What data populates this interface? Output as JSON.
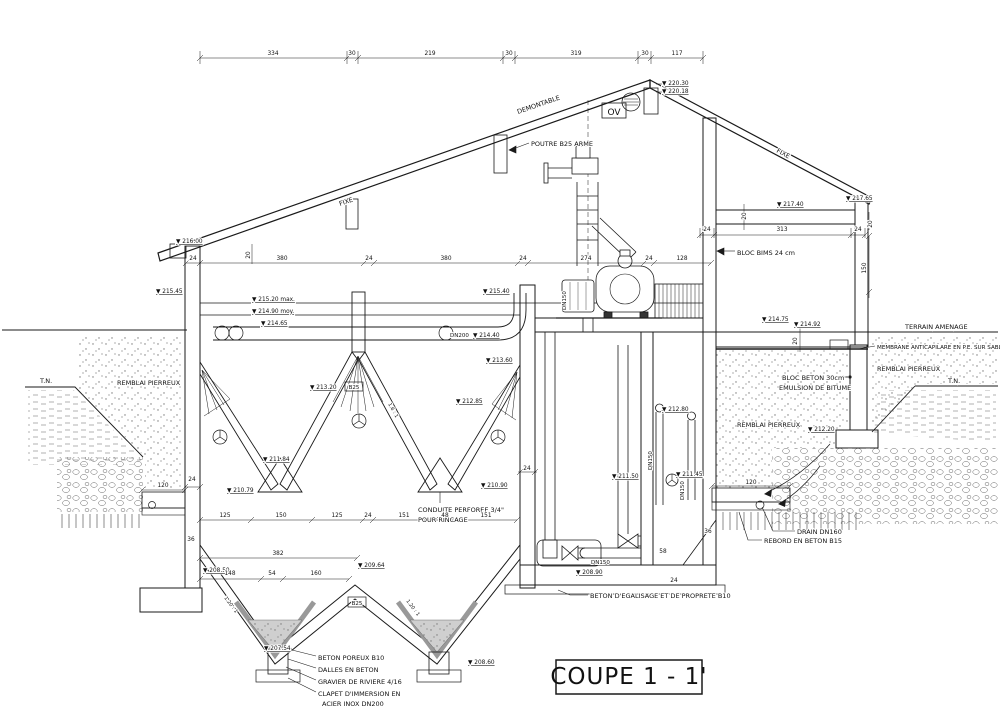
{
  "title": "COUPE 1 - 1'",
  "colors": {
    "line": "#1a1a1a",
    "background": "#ffffff",
    "gray_fill": "#9a9a9a",
    "gravel": "#cfcfcf"
  },
  "annotations": [
    {
      "name": "label-poutre-b25-arme",
      "text": "POUTRE B25 ARME",
      "x": 531,
      "y": 146
    },
    {
      "name": "label-demontable",
      "text": "DEMONTABLE",
      "x": 518,
      "y": 114,
      "rot": -19
    },
    {
      "name": "label-fixe-left",
      "text": "FIXE",
      "x": 340,
      "y": 206,
      "rot": -19
    },
    {
      "name": "label-fixe-right",
      "text": "FIXE",
      "x": 776,
      "y": 152,
      "rot": 28
    },
    {
      "name": "label-ov",
      "text": "OV",
      "x": 614,
      "y": 115,
      "size": 9,
      "anchor": "middle"
    },
    {
      "name": "label-bloc-bims",
      "text": "BLOC BIMS 24 cm",
      "x": 737,
      "y": 255
    },
    {
      "name": "label-terrain-amenage",
      "text": "TERRAIN AMENAGE",
      "x": 905,
      "y": 329
    },
    {
      "name": "label-membrane",
      "text": "MEMBRANE ANTICAPILARE EN P.E. SUR SABLE",
      "x": 877,
      "y": 349,
      "size": 5.6
    },
    {
      "name": "label-remblai-right-outer",
      "text": "REMBLAI PIERREUX",
      "x": 877,
      "y": 371
    },
    {
      "name": "label-bloc-beton",
      "text": "BLOC BETON 30cm",
      "x": 782,
      "y": 380
    },
    {
      "name": "label-emulsion-bitume",
      "text": "EMULSION DE BITUME",
      "x": 779,
      "y": 390
    },
    {
      "name": "label-remblai-right-inner",
      "text": "REMBLAI PIERREUX",
      "x": 737,
      "y": 427
    },
    {
      "name": "label-remblai-left",
      "text": "REMBLAI PIERREUX",
      "x": 117,
      "y": 385
    },
    {
      "name": "label-tn-left",
      "text": "T.N.",
      "x": 40,
      "y": 383
    },
    {
      "name": "label-tn-right",
      "text": "T.N.",
      "x": 948,
      "y": 383
    },
    {
      "name": "label-drain-dn160",
      "text": "DRAIN DN160",
      "x": 797,
      "y": 534
    },
    {
      "name": "label-rebord-beton",
      "text": "REBORD EN BETON B15",
      "x": 764,
      "y": 543
    },
    {
      "name": "label-beton-egalisage",
      "text": "BETON D'EGALISAGE ET DE PROPRETE B10",
      "x": 590,
      "y": 598
    },
    {
      "name": "label-beton-poreux",
      "text": "BETON POREUX B10",
      "x": 318,
      "y": 660
    },
    {
      "name": "label-dalles-beton",
      "text": "DALLES EN BETON",
      "x": 318,
      "y": 672
    },
    {
      "name": "label-gravier-riviere",
      "text": "GRAVIER DE RIVIERE 4/16",
      "x": 318,
      "y": 684
    },
    {
      "name": "label-clapet-line1",
      "text": "CLAPET D'IMMERSION EN",
      "x": 318,
      "y": 696
    },
    {
      "name": "label-clapet-line2",
      "text": "ACIER INOX DN200",
      "x": 322,
      "y": 706
    },
    {
      "name": "label-conduite-line1",
      "text": "CONDUITE PERFOREE 3/4\"",
      "x": 418,
      "y": 512
    },
    {
      "name": "label-conduite-line2",
      "text": "POUR RINCAGE",
      "x": 418,
      "y": 522
    },
    {
      "name": "label-dn200",
      "text": "DN200",
      "x": 450,
      "y": 337,
      "size": 5.5
    },
    {
      "name": "label-dn150-horizontal",
      "text": "DN150",
      "x": 591,
      "y": 564,
      "size": 5.5
    },
    {
      "name": "label-dn150-pipe1",
      "text": "DN150",
      "x": 652,
      "y": 470,
      "rot": -90,
      "size": 5.5
    },
    {
      "name": "label-dn150-pipe2",
      "text": "DN150",
      "x": 684,
      "y": 500,
      "rot": -90,
      "size": 5.5
    },
    {
      "name": "label-dn150-discharge",
      "text": "DN150",
      "x": 566,
      "y": 310,
      "rot": -90,
      "size": 5.5
    },
    {
      "name": "label-b25-column",
      "text": "B25",
      "x": 354,
      "y": 389,
      "size": 5.5,
      "anchor": "middle"
    },
    {
      "name": "label-b25-ridge",
      "text": "B25",
      "x": 357,
      "y": 605,
      "size": 5.5,
      "anchor": "middle"
    },
    {
      "name": "label-slope-left",
      "text": "1.20 : 1",
      "x": 224,
      "y": 598,
      "rot": 53,
      "size": 5
    },
    {
      "name": "label-slope-mid",
      "text": "1.20 : 1",
      "x": 406,
      "y": 601,
      "rot": 53,
      "size": 5
    },
    {
      "name": "label-slope-lamella",
      "text": "1.6 : 1",
      "x": 388,
      "y": 404,
      "rot": 61,
      "size": 5
    }
  ],
  "elevations": [
    {
      "name": "elev-220-30",
      "text": "▼ 220.30",
      "x": 662,
      "y": 85
    },
    {
      "name": "elev-220-18",
      "text": "▼ 220.18",
      "x": 662,
      "y": 93
    },
    {
      "name": "elev-217-40",
      "text": "▼ 217.40",
      "x": 777,
      "y": 206
    },
    {
      "name": "elev-217-65",
      "text": "▼ 217.65",
      "x": 846,
      "y": 200
    },
    {
      "name": "elev-216-00",
      "text": "▼ 216.00",
      "x": 176,
      "y": 243
    },
    {
      "name": "elev-215-45",
      "text": "▼ 215.45",
      "x": 156,
      "y": 293
    },
    {
      "name": "elev-215-20-max",
      "text": "▼ 215.20 max.",
      "x": 252,
      "y": 301
    },
    {
      "name": "elev-214-90-moy",
      "text": "▼ 214.90 moy.",
      "x": 252,
      "y": 313
    },
    {
      "name": "elev-214-65",
      "text": "▼ 214.65",
      "x": 261,
      "y": 325
    },
    {
      "name": "elev-214-40",
      "text": "▼ 214.40",
      "x": 473,
      "y": 337
    },
    {
      "name": "elev-215-40",
      "text": "▼ 215.40",
      "x": 483,
      "y": 293
    },
    {
      "name": "elev-213-60",
      "text": "▼ 213.60",
      "x": 486,
      "y": 362
    },
    {
      "name": "elev-213-20",
      "text": "▼ 213.20",
      "x": 310,
      "y": 389
    },
    {
      "name": "elev-212-85",
      "text": "▼ 212.85",
      "x": 456,
      "y": 403
    },
    {
      "name": "elev-211-84",
      "text": "▼ 211.84",
      "x": 263,
      "y": 461
    },
    {
      "name": "elev-210-79",
      "text": "▼ 210.79",
      "x": 227,
      "y": 492
    },
    {
      "name": "elev-210-90",
      "text": "▼ 210.90",
      "x": 481,
      "y": 487
    },
    {
      "name": "elev-214-75",
      "text": "▼ 214.75",
      "x": 762,
      "y": 321
    },
    {
      "name": "elev-214-92",
      "text": "▼ 214.92",
      "x": 794,
      "y": 326
    },
    {
      "name": "elev-212-20",
      "text": "▼ 212.20",
      "x": 808,
      "y": 431
    },
    {
      "name": "elev-212-80",
      "text": "▼ 212.80",
      "x": 662,
      "y": 411
    },
    {
      "name": "elev-211-50",
      "text": "▼ 211.50",
      "x": 612,
      "y": 478
    },
    {
      "name": "elev-211-45",
      "text": "▼ 211.45",
      "x": 676,
      "y": 476
    },
    {
      "name": "elev-208-50",
      "text": "▼ 208.50",
      "x": 203,
      "y": 572
    },
    {
      "name": "elev-209-64",
      "text": "▼ 209.64",
      "x": 358,
      "y": 567
    },
    {
      "name": "elev-208-90",
      "text": "▼ 208.90",
      "x": 576,
      "y": 574
    },
    {
      "name": "elev-207-54",
      "text": "▼ 207.54",
      "x": 264,
      "y": 650
    },
    {
      "name": "elev-208-60",
      "text": "▼ 208.60",
      "x": 468,
      "y": 664
    }
  ],
  "dimensions": [
    {
      "name": "dim-top-334",
      "text": "334",
      "x": 273,
      "y": 55
    },
    {
      "name": "dim-top-30a",
      "text": "30",
      "x": 352,
      "y": 55
    },
    {
      "name": "dim-top-219",
      "text": "219",
      "x": 430,
      "y": 55
    },
    {
      "name": "dim-top-30b",
      "text": "30",
      "x": 509,
      "y": 55
    },
    {
      "name": "dim-top-319",
      "text": "319",
      "x": 576,
      "y": 55
    },
    {
      "name": "dim-top-30c",
      "text": "30",
      "x": 645,
      "y": 55
    },
    {
      "name": "dim-top-117",
      "text": "117",
      "x": 677,
      "y": 55
    },
    {
      "name": "dim-int-24a",
      "text": "24",
      "x": 193,
      "y": 260
    },
    {
      "name": "dim-int-380a",
      "text": "380",
      "x": 282,
      "y": 260
    },
    {
      "name": "dim-int-24b",
      "text": "24",
      "x": 369,
      "y": 260
    },
    {
      "name": "dim-int-380b",
      "text": "380",
      "x": 446,
      "y": 260
    },
    {
      "name": "dim-int-24c",
      "text": "24",
      "x": 523,
      "y": 260
    },
    {
      "name": "dim-int-274",
      "text": "274",
      "x": 586,
      "y": 260
    },
    {
      "name": "dim-int-24d",
      "text": "24",
      "x": 649,
      "y": 260
    },
    {
      "name": "dim-int-128",
      "text": "128",
      "x": 682,
      "y": 260
    },
    {
      "name": "dim-room-24a",
      "text": "24",
      "x": 707,
      "y": 231
    },
    {
      "name": "dim-room-313",
      "text": "313",
      "x": 782,
      "y": 231
    },
    {
      "name": "dim-room-24b",
      "text": "24",
      "x": 858,
      "y": 231
    },
    {
      "name": "dim-floor-125a",
      "text": "125",
      "x": 225,
      "y": 517
    },
    {
      "name": "dim-floor-150",
      "text": "150",
      "x": 281,
      "y": 517
    },
    {
      "name": "dim-floor-125b",
      "text": "125",
      "x": 337,
      "y": 517
    },
    {
      "name": "dim-floor-24",
      "text": "24",
      "x": 368,
      "y": 517
    },
    {
      "name": "dim-floor-151a",
      "text": "151",
      "x": 404,
      "y": 517
    },
    {
      "name": "dim-floor-48",
      "text": "48",
      "x": 445,
      "y": 517
    },
    {
      "name": "dim-floor-151b",
      "text": "151",
      "x": 486,
      "y": 517
    },
    {
      "name": "dim-total-382",
      "text": "382",
      "x": 278,
      "y": 555
    },
    {
      "name": "dim-low-148",
      "text": "148",
      "x": 230,
      "y": 575
    },
    {
      "name": "dim-low-54",
      "text": "54",
      "x": 272,
      "y": 575
    },
    {
      "name": "dim-low-160",
      "text": "160",
      "x": 316,
      "y": 575
    },
    {
      "name": "dim-left-120",
      "text": "120",
      "x": 163,
      "y": 487
    },
    {
      "name": "dim-left-24",
      "text": "24",
      "x": 192,
      "y": 481
    },
    {
      "name": "dim-left-36",
      "text": "36",
      "x": 191,
      "y": 541
    },
    {
      "name": "dim-right-120",
      "text": "120",
      "x": 751,
      "y": 484
    },
    {
      "name": "dim-right-36",
      "text": "36",
      "x": 708,
      "y": 533
    },
    {
      "name": "dim-right-24",
      "text": "24",
      "x": 674,
      "y": 582
    },
    {
      "name": "dim-right-58",
      "text": "58",
      "x": 663,
      "y": 553
    },
    {
      "name": "dim-wall-24",
      "text": "24",
      "x": 527,
      "y": 470
    },
    {
      "name": "dim-slab-20a",
      "text": "20",
      "x": 746,
      "y": 216,
      "rot": -90
    },
    {
      "name": "dim-wall-20b",
      "text": "20",
      "x": 872,
      "y": 224,
      "rot": -90
    },
    {
      "name": "dim-wall-150",
      "text": "150",
      "x": 866,
      "y": 268,
      "rot": -90
    },
    {
      "name": "dim-eave-20",
      "text": "20",
      "x": 250,
      "y": 255,
      "rot": -90
    },
    {
      "name": "dim-slab-20c",
      "text": "20",
      "x": 797,
      "y": 341,
      "rot": -90
    }
  ]
}
